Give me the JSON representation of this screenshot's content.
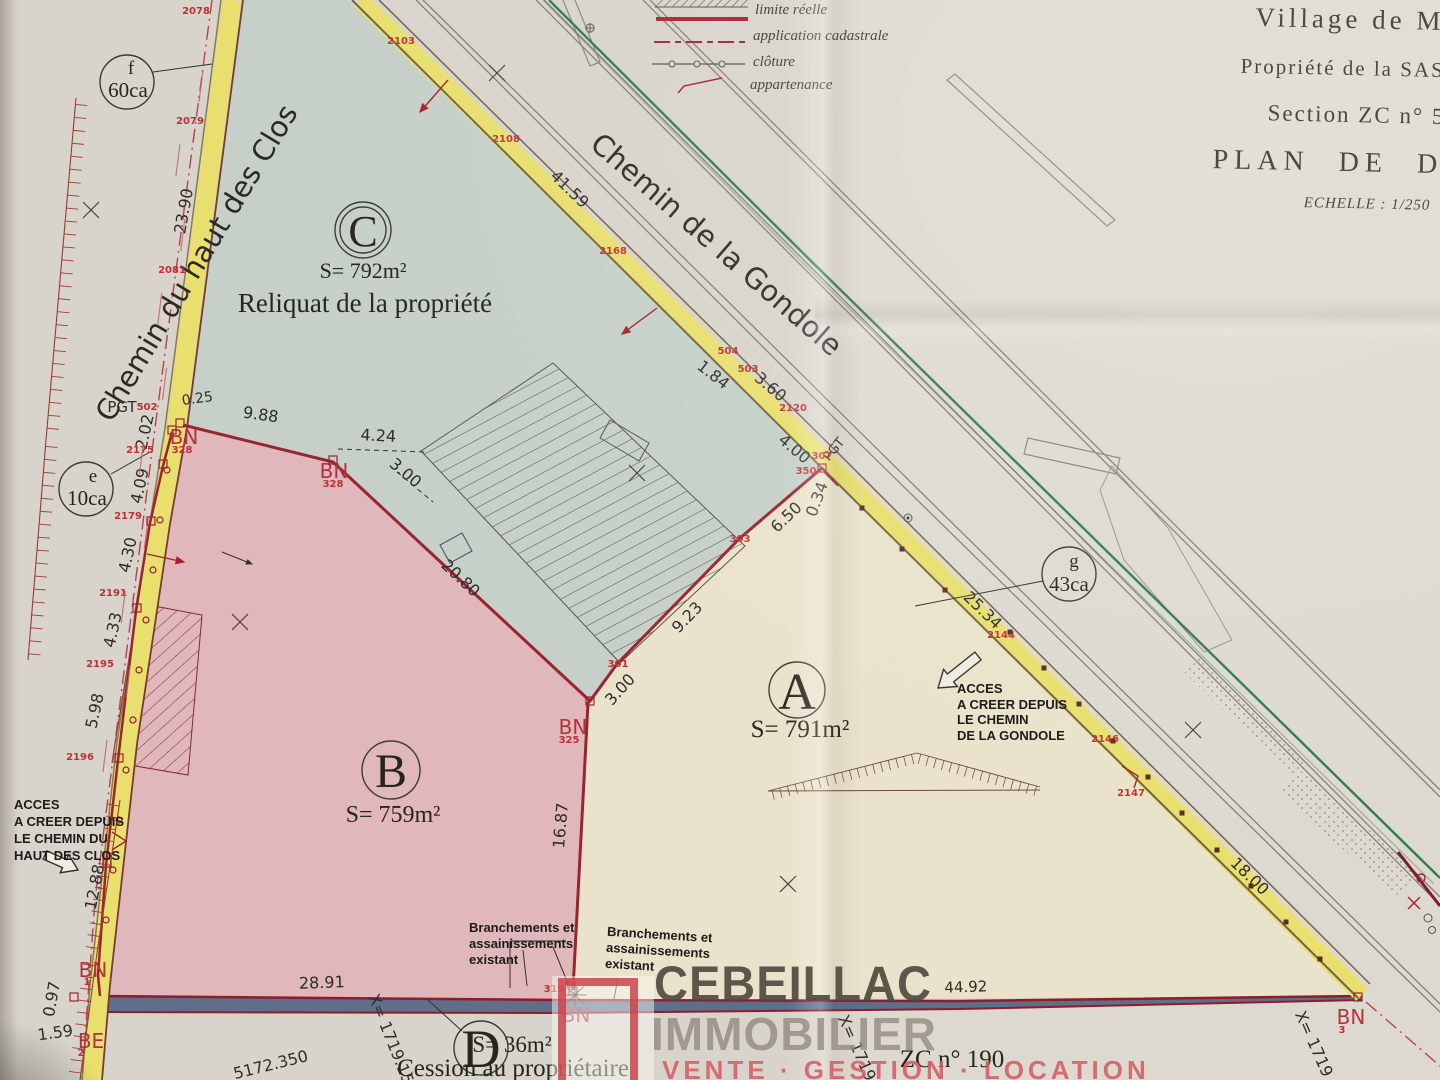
{
  "title_block": {
    "line1": "Village de MEZ",
    "line2": "Propriété de la SAS",
    "line3": "Section ZC n° 5",
    "line4": "PLAN DE DIVI",
    "scale": "ECHELLE : 1/250"
  },
  "legend": {
    "items": [
      "limite réelle",
      "application cadastrale",
      "clôture",
      "appartenance"
    ]
  },
  "roads": {
    "west": "Chemin du haut des Clos",
    "northeast": "Chemin de la Gondole"
  },
  "parcels": {
    "c": {
      "letter": "C",
      "area": "S= 792m²",
      "note": "Reliquat de la propriété"
    },
    "b": {
      "letter": "B",
      "area": "S= 759m²"
    },
    "a": {
      "letter": "A",
      "area": "S= 791m²"
    },
    "d": {
      "letter": "D",
      "area": "S= 36m²",
      "note": "Cession au propriétaire"
    }
  },
  "zones": {
    "f": {
      "letter": "f",
      "area": "60ca"
    },
    "e": {
      "letter": "e",
      "area": "10ca"
    },
    "g": {
      "letter": "g",
      "area": "43ca"
    }
  },
  "notes": {
    "access_clos": [
      "ACCES",
      "A CREER DEPUIS",
      "LE CHEMIN DU",
      "HAUT DES CLOS"
    ],
    "access_gondole": [
      "ACCES",
      "A CREER DEPUIS",
      "LE CHEMIN",
      "DE LA GONDOLE"
    ],
    "branch1": [
      "Branchements et",
      "assainissements",
      "existant"
    ],
    "branch2": [
      "Branchements et",
      "assainissements",
      "existant"
    ]
  },
  "watermark": {
    "name": "CEBEILLAC",
    "type": "IMMOBILIER",
    "tagline": "VENTE · GESTION · LOCATION"
  },
  "footer": {
    "zc": "ZC n° 190"
  },
  "colors": {
    "parcel_a": "#eae2ca",
    "parcel_b": "#e0b7ba",
    "parcel_c": "#c6cfc8",
    "parcel_d": "#5f6e89",
    "road_yellow": "#e8df6e",
    "boundary_red": "#9a2430",
    "label_red": "#c03038",
    "fence_green": "#2e7b4a"
  },
  "measurements": [
    {
      "t": "23.90",
      "x": 189,
      "y": 212,
      "r": -80
    },
    {
      "t": "0.25",
      "x": 198,
      "y": 403,
      "r": -8,
      "s": 14
    },
    {
      "t": "2.02",
      "x": 150,
      "y": 433,
      "r": -78
    },
    {
      "t": "4.09",
      "x": 145,
      "y": 487,
      "r": -78
    },
    {
      "t": "4.30",
      "x": 133,
      "y": 556,
      "r": -78
    },
    {
      "t": "4.33",
      "x": 118,
      "y": 631,
      "r": -78
    },
    {
      "t": "5.98",
      "x": 100,
      "y": 712,
      "r": -78
    },
    {
      "t": "12.88",
      "x": 100,
      "y": 888,
      "r": -79
    },
    {
      "t": "0.97",
      "x": 57,
      "y": 1000,
      "r": -80
    },
    {
      "t": "1.59",
      "x": 56,
      "y": 1038,
      "r": -8
    },
    {
      "t": "9.88",
      "x": 260,
      "y": 420,
      "r": 8
    },
    {
      "t": "4.24",
      "x": 378,
      "y": 441,
      "r": 3
    },
    {
      "t": "3.00",
      "x": 402,
      "y": 477,
      "r": 40
    },
    {
      "t": "20.80",
      "x": 457,
      "y": 582,
      "r": 43
    },
    {
      "t": "3.00",
      "x": 624,
      "y": 693,
      "r": -48
    },
    {
      "t": "9.23",
      "x": 691,
      "y": 621,
      "r": -46
    },
    {
      "t": "6.50",
      "x": 790,
      "y": 521,
      "r": -44
    },
    {
      "t": "0.34",
      "x": 822,
      "y": 501,
      "r": -70
    },
    {
      "t": "1.84",
      "x": 710,
      "y": 379,
      "r": 38
    },
    {
      "t": "3.60",
      "x": 767,
      "y": 391,
      "r": 40
    },
    {
      "t": "4.00",
      "x": 791,
      "y": 453,
      "r": 40
    },
    {
      "t": "41.59",
      "x": 566,
      "y": 193,
      "r": 44
    },
    {
      "t": "25.34",
      "x": 979,
      "y": 614,
      "r": 44
    },
    {
      "t": "18.00",
      "x": 1246,
      "y": 880,
      "r": 44
    },
    {
      "t": "16.87",
      "x": 566,
      "y": 826,
      "r": -85
    },
    {
      "t": "28.91",
      "x": 322,
      "y": 988,
      "r": -2
    },
    {
      "t": "44.92",
      "x": 966,
      "y": 992,
      "r": -2,
      "s": 15
    },
    {
      "t": "PGT",
      "x": 122,
      "y": 412,
      "s": 15
    },
    {
      "t": "PGT",
      "x": 837,
      "y": 452,
      "r": -50,
      "s": 13
    }
  ],
  "point_labels": [
    {
      "t": "2078",
      "x": 196,
      "y": 14
    },
    {
      "t": "2079",
      "x": 190,
      "y": 124
    },
    {
      "t": "2081",
      "x": 172,
      "y": 273
    },
    {
      "t": "2103",
      "x": 401,
      "y": 44
    },
    {
      "t": "2108",
      "x": 506,
      "y": 142
    },
    {
      "t": "2168",
      "x": 613,
      "y": 254
    },
    {
      "t": "504",
      "x": 728,
      "y": 354
    },
    {
      "t": "503",
      "x": 748,
      "y": 372
    },
    {
      "t": "2120",
      "x": 793,
      "y": 411
    },
    {
      "t": "307",
      "x": 822,
      "y": 459
    },
    {
      "t": "350",
      "x": 806,
      "y": 474
    },
    {
      "t": "303",
      "x": 740,
      "y": 542
    },
    {
      "t": "301",
      "x": 618,
      "y": 667
    },
    {
      "t": "2144",
      "x": 1001,
      "y": 638
    },
    {
      "t": "2146",
      "x": 1105,
      "y": 742
    },
    {
      "t": "2147",
      "x": 1131,
      "y": 796
    },
    {
      "t": "502",
      "x": 147,
      "y": 410
    },
    {
      "t": "2175",
      "x": 140,
      "y": 453
    },
    {
      "t": "2179",
      "x": 128,
      "y": 519
    },
    {
      "t": "2191",
      "x": 113,
      "y": 596
    },
    {
      "t": "2195",
      "x": 100,
      "y": 667
    },
    {
      "t": "2196",
      "x": 80,
      "y": 760
    },
    {
      "t": "328",
      "x": 182,
      "y": 453
    },
    {
      "t": "328",
      "x": 333,
      "y": 487
    },
    {
      "t": "325",
      "x": 569,
      "y": 743
    },
    {
      "t": "319",
      "x": 554,
      "y": 992
    },
    {
      "t": "1",
      "x": 87,
      "y": 985
    },
    {
      "t": "2",
      "x": 81,
      "y": 1056
    },
    {
      "t": "3",
      "x": 1342,
      "y": 1033
    }
  ],
  "bn_labels": [
    {
      "t": "BN",
      "x": 184,
      "y": 444
    },
    {
      "t": "BN",
      "x": 334,
      "y": 478
    },
    {
      "t": "BN",
      "x": 573,
      "y": 734
    },
    {
      "t": "BN",
      "x": 576,
      "y": 1022
    },
    {
      "t": "BN",
      "x": 93,
      "y": 977
    },
    {
      "t": "BE",
      "x": 91,
      "y": 1048
    },
    {
      "t": "BN",
      "x": 1351,
      "y": 1024
    }
  ],
  "coord_labels": [
    {
      "t": "X= 1719.15",
      "x": 386,
      "y": 1041,
      "r": 68
    },
    {
      "t": "5172.350",
      "x": 272,
      "y": 1070,
      "r": -14
    },
    {
      "t": "X= 1719",
      "x": 852,
      "y": 1050,
      "r": 66
    },
    {
      "t": "X= 1719",
      "x": 1309,
      "y": 1046,
      "r": 66
    }
  ]
}
